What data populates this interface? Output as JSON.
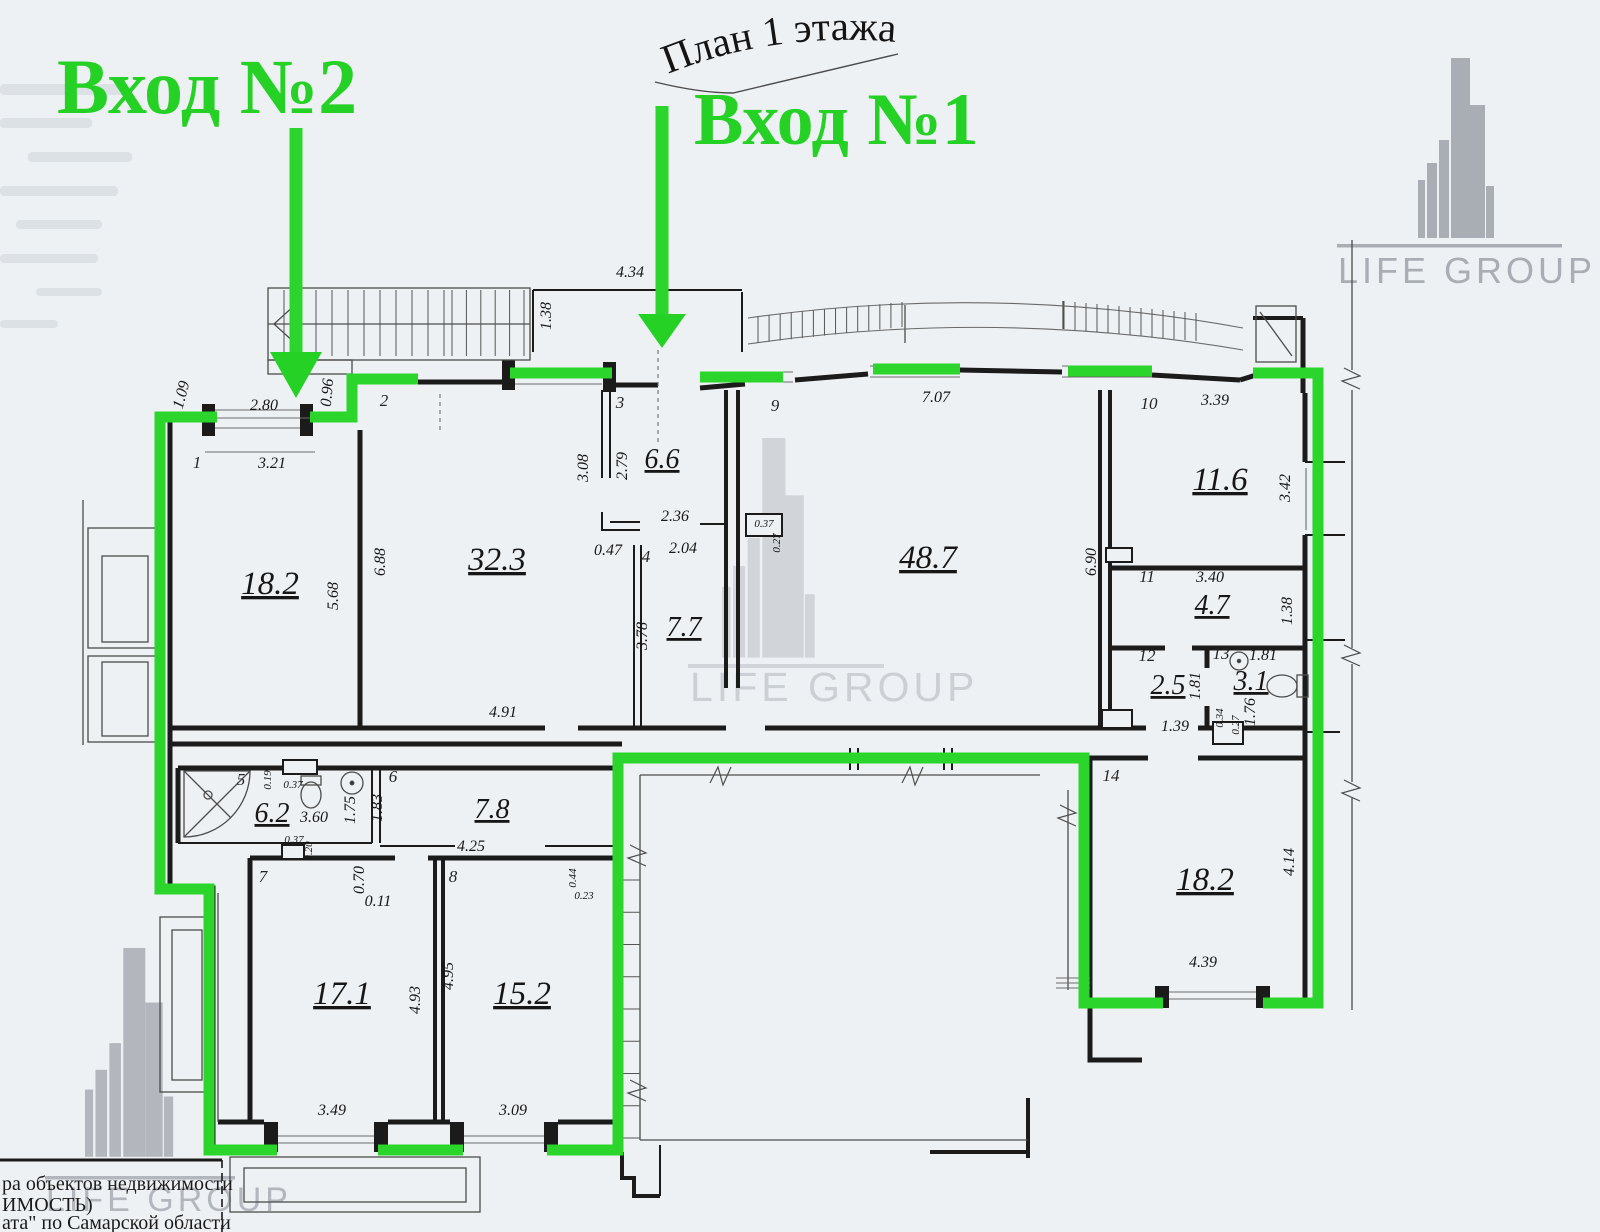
{
  "title": "План 1 этажа",
  "entrances": {
    "e1": "Вход №1",
    "e2": "Вход №2"
  },
  "brand": {
    "name": "LIFE GROUP"
  },
  "stamp": {
    "line1": "ра объектов недвижимости",
    "line2": "ИМОСТЬ)",
    "line3": "ата\" по Самарской области"
  },
  "colors": {
    "accent_green": "#2bd52b",
    "wall_black": "#1b1b1b",
    "logo_gray": "#a9aeb4"
  },
  "rooms": [
    {
      "num": "1",
      "area": "18.2"
    },
    {
      "num": "2",
      "area": "32.3"
    },
    {
      "num": "3",
      "area": "6.6"
    },
    {
      "num": "4",
      "area": "7.7"
    },
    {
      "num": "5",
      "area": "6.2"
    },
    {
      "num": "6",
      "area": "7.8"
    },
    {
      "num": "7",
      "area": "17.1"
    },
    {
      "num": "8",
      "area": "15.2"
    },
    {
      "num": "9",
      "area": "48.7"
    },
    {
      "num": "10",
      "area": "11.6"
    },
    {
      "num": "11",
      "area": "4.7"
    },
    {
      "num": "12",
      "area": "2.5"
    },
    {
      "num": "13",
      "area": "3.1"
    },
    {
      "num": "14",
      "area": "18.2"
    }
  ],
  "dims": {
    "d434": "4.34",
    "d138a": "1.38",
    "d109": "1.09",
    "d280": "2.80",
    "d096": "0.96",
    "d321": "3.21",
    "d707": "7.07",
    "d568": "5.68",
    "d688": "6.88",
    "d308": "3.08",
    "d279": "2.79",
    "d236": "2.36",
    "d047": "0.47",
    "d204": "2.04",
    "d037a": "0.37",
    "d027a": "0.27",
    "d378": "3.78",
    "d690": "6.90",
    "d339": "3.39",
    "d342": "3.42",
    "d340": "3.40",
    "d138b": "1.38",
    "d181a": "1.81",
    "d181b": "1.81",
    "d176": "1.76",
    "d034": "0.34",
    "d027b": "0.27",
    "d139": "1.39",
    "d019": "0.19",
    "d037b": "0.37",
    "d360": "3.60",
    "d037c": "0.37",
    "d020": "0.20",
    "d175": "1.75",
    "d183": "1.83",
    "d425": "4.25",
    "d070": "0.70",
    "d011": "0.11",
    "d044": "0.44",
    "d023": "0.23",
    "d493": "4.93",
    "d495": "4.95",
    "d349": "3.49",
    "d309": "3.09",
    "d414": "4.14",
    "d439": "4.39",
    "d491": "4.91"
  }
}
